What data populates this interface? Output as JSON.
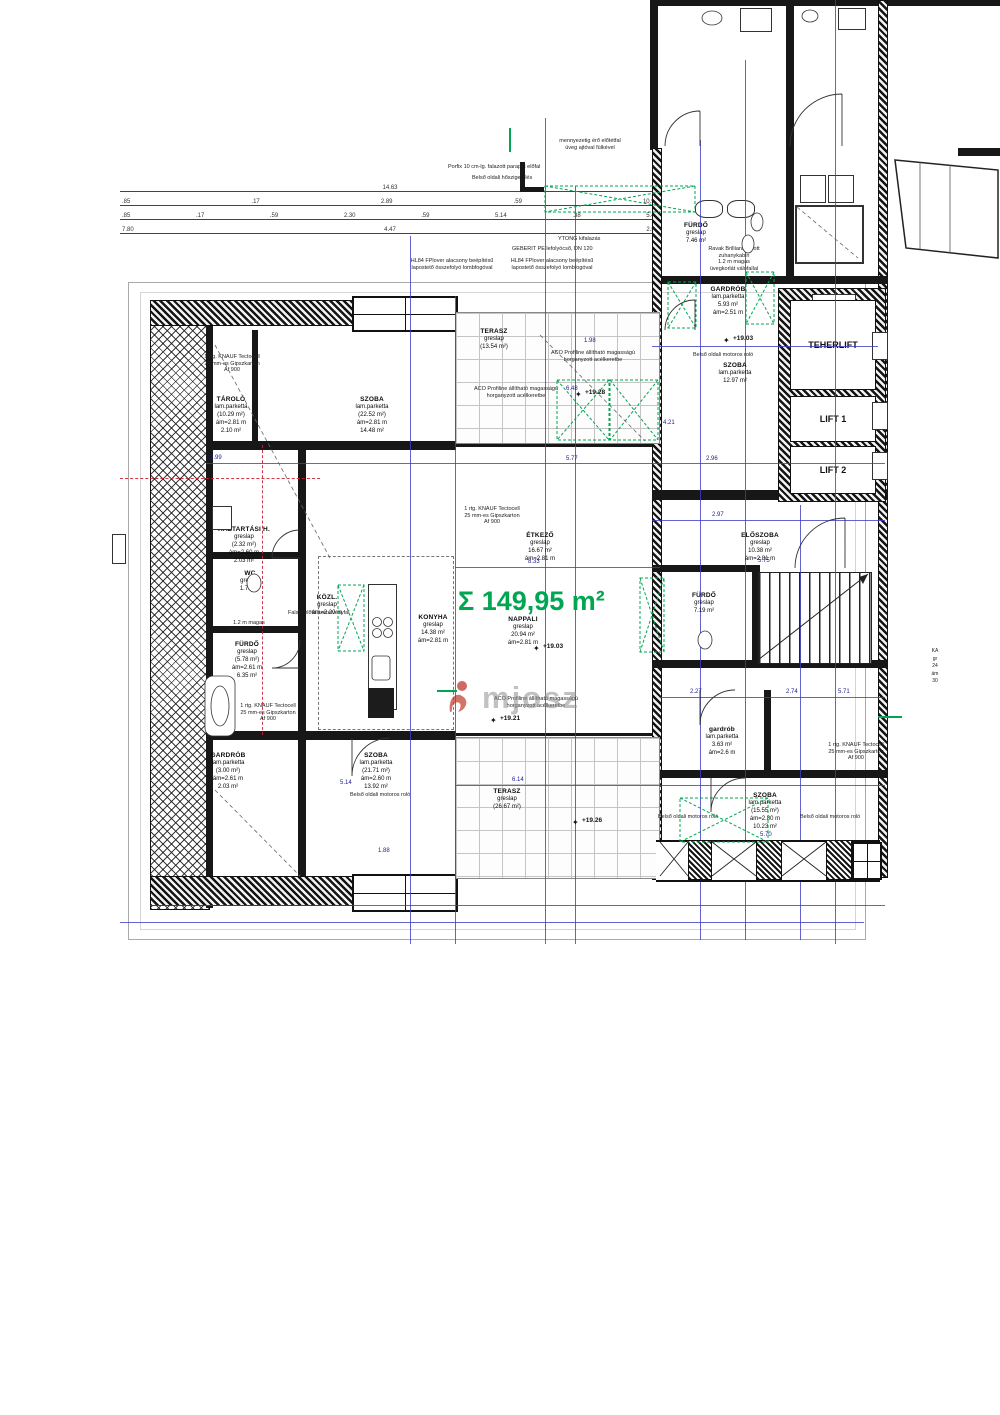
{
  "colors": {
    "dim_blue": "#3c3cc0",
    "green": "#00a651",
    "axis_red": "#cc2233",
    "wall": "#171717",
    "tile_grid": "#c4c4c4"
  },
  "sum_area": "Σ 149,95 m²",
  "watermark": "mjosz",
  "dim_rows": {
    "r1": [
      "14.63"
    ],
    "r2": [
      ".85",
      ".17",
      "2.89",
      ".59",
      "10.98"
    ],
    "r3": [
      ".85",
      ".17",
      ".59",
      "2.30",
      ".59",
      "5.14",
      ".38",
      "5.48"
    ],
    "r4": [
      "7.80",
      "4.47",
      "2.58"
    ]
  },
  "lifts": {
    "teher": [
      "TEHER",
      "LIFT"
    ],
    "lift1": "LIFT 1",
    "lift2": "LIFT 2"
  },
  "rooms": {
    "tarolo": {
      "lines": [
        "TÁROLÓ",
        "lam.parketta",
        "(10.29 m²)",
        "ám=2.81 m",
        "2.10 m²"
      ]
    },
    "szoba_top": {
      "lines": [
        "SZOBA",
        "lam.parketta",
        "(22.52 m²)",
        "ám=2.81 m",
        "14.48 m²"
      ]
    },
    "terasz_top": {
      "lines": [
        "TERASZ",
        "greslap",
        "(13.54 m²)"
      ]
    },
    "furdo_topright": {
      "lines": [
        "FÜRDŐ",
        "greslap",
        "7.46 m²"
      ]
    },
    "gardrob_topright": {
      "lines": [
        "GARDRÓB",
        "lam.parketta",
        "5.93 m²",
        "ám=2.51 m"
      ]
    },
    "szoba_right": {
      "lines": [
        "SZOBA",
        "lam.parketta",
        "12.97 m²"
      ]
    },
    "etkezo": {
      "lines": [
        "ÉTKEZŐ",
        "greslap",
        "16.67 m²",
        "ám=2.81 m"
      ]
    },
    "konyha": {
      "lines": [
        "KONYHA",
        "greslap",
        "14.38 m²",
        "ám=2.81 m"
      ]
    },
    "nappali": {
      "lines": [
        "NAPPALI",
        "greslap",
        "20.94 m²",
        "ám=2.81 m"
      ]
    },
    "haztartasi": {
      "lines": [
        "HÁZTARTÁSI H.",
        "greslap",
        "(2.32 m²)",
        "ám=2.60 m",
        "2.03 m²"
      ]
    },
    "wc": {
      "lines": [
        "WC",
        "greslap",
        "1.71 m²"
      ]
    },
    "kozl": {
      "lines": [
        "KÖZL.",
        "greslap",
        "ám=2.20 m"
      ]
    },
    "furdo_left": {
      "lines": [
        "FÜRDŐ",
        "greslap",
        "(5.78 m²)",
        "ám=2.61 m",
        "6.35 m²"
      ]
    },
    "eloszoba": {
      "lines": [
        "ELŐSZOBA",
        "greslap",
        "10.38 m²",
        "ám=2.81 m"
      ]
    },
    "furdo_right": {
      "lines": [
        "FÜRDŐ",
        "greslap",
        "7.19 m²"
      ]
    },
    "gardrob_small": {
      "lines": [
        "gardrób",
        "lam.parketta",
        "3.63 m²",
        "ám=2.6 m"
      ]
    },
    "gardrob_bottomleft": {
      "lines": [
        "GARDRÓB",
        "lam.parketta",
        "(3.00 m²)",
        "ám=2.61 m",
        "2.03 m²"
      ]
    },
    "szoba_bottom": {
      "lines": [
        "SZOBA",
        "lam.parketta",
        "(21.71 m²)",
        "ám=2.60 m",
        "13.92 m²"
      ]
    },
    "terasz_bottom": {
      "lines": [
        "TERASZ",
        "greslap",
        "(26.67 m²)"
      ]
    },
    "szoba_bottomright": {
      "lines": [
        "SZOBA",
        "lam.parketta",
        "(15.55 m²)",
        "ám=2.80 m",
        "10.23 m²"
      ]
    }
  },
  "annotations": {
    "ytong": "YTONG kifalazás",
    "geberit": "GEBERIT PE lefolyócső, DN 120",
    "hl84": [
      "HL84 FPlover alacsony beépítésű",
      "lapostető összefolyó lombfogóval"
    ],
    "elotetfal": [
      "mennyezetig érő előtétfal",
      "üveg ajtóval fülkével"
    ],
    "porfix": "Porfix 10 cm-lg. falazott parapet előfal",
    "hoszig": "Belső oldali hőszigetelés",
    "ravak": [
      "Ravak Brilliant nyitott",
      "zuhanykabin",
      "1.2 m magas",
      "üvegkorlát válófallal"
    ],
    "uvegkorlat": [
      "1.2 m magas",
      "üvegkorlát válófal"
    ],
    "falsik": "Falsík előtti szerelvényfal",
    "aco": [
      "ACO Profiline állítható magasságú",
      "horganyzott acélkeretbe"
    ],
    "rolo": "Belső oldali motoros roló",
    "knauf": [
      "1 rtg. KNAUF Tectocell",
      "25 mm-es Gipszkarton",
      "Af 900"
    ]
  },
  "elevations": {
    "e1": "+19.28",
    "e2": "+19.03",
    "e3": "+19.03",
    "e4": "+19.21",
    "e5": "+19.26"
  },
  "scattered_dims": {
    "s1": "5.77",
    "s2": "6.48",
    "s3": "8.33",
    "s4": "2.97",
    "s5": "2.96",
    "s6": "5.75",
    "s7": "5.71",
    "s8": "2.74",
    "s9": "2.27",
    "s10": "6.14",
    "s11": "5.14",
    "s12": "2.99",
    "s13": "5.70",
    "s14": "1.88",
    "s15": "1.98",
    "s16": "4.21"
  },
  "edge_label": {
    "lines": [
      "KA",
      "gr",
      "24",
      "ám",
      "30"
    ]
  }
}
